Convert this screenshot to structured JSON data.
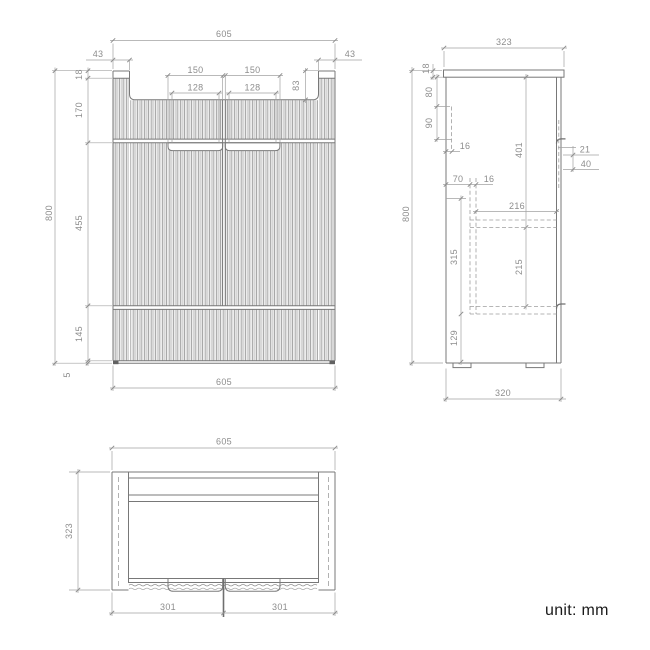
{
  "caption": {
    "unit_label": "unit: mm"
  },
  "front_view": {
    "dims": {
      "width_top": "605",
      "side_panel_left": "43",
      "side_panel_right": "43",
      "top_thickness": "18",
      "upper_height": "170",
      "handle_outer_left": "150",
      "handle_outer_right": "150",
      "handle_inner_left": "128",
      "handle_inner_right": "128",
      "recess_depth": "83",
      "door_height": "455",
      "drawer_height": "145",
      "base_gap": "5",
      "total_height": "800",
      "width_bottom": "605"
    }
  },
  "side_view": {
    "dims": {
      "depth_top": "323",
      "top_thickness": "18",
      "rail_top_offset": "80",
      "rail_height": "90",
      "back_panel_thickness": "16",
      "drawer_back_offset": "70",
      "panel_thickness": "16",
      "inner_depth": "216",
      "upper_inner_height": "401",
      "handle_lip": "21",
      "handle_recess": "40",
      "lower_inner_height": "315",
      "shelf_spacing": "215",
      "base_height": "129",
      "total_height": "800",
      "depth_bottom": "320"
    }
  },
  "top_view": {
    "dims": {
      "width": "605",
      "depth": "323",
      "door_left": "301",
      "door_right": "301"
    }
  }
}
